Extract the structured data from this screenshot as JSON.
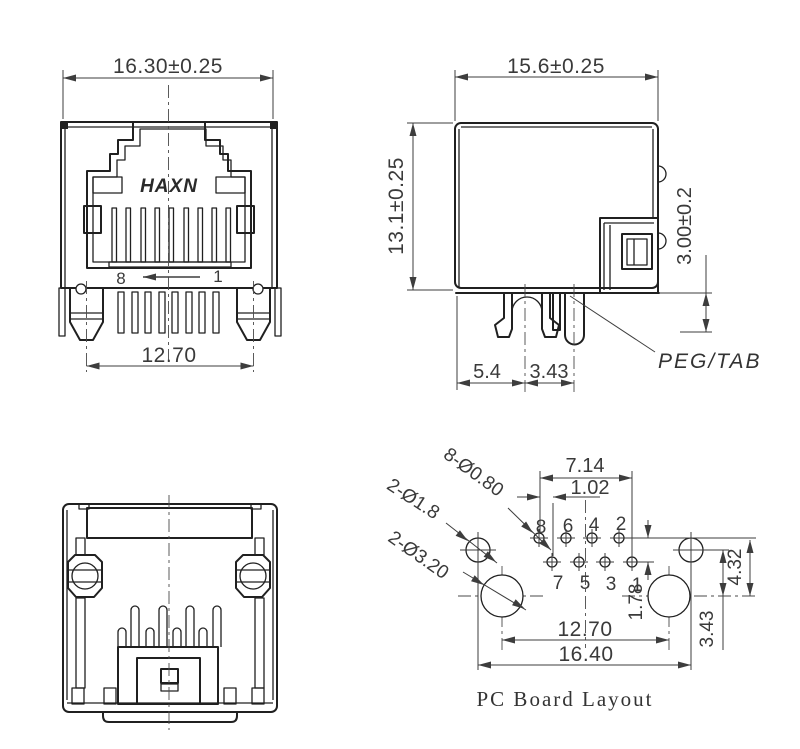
{
  "front_view": {
    "width_dim": "16.30±0.25",
    "peg_spacing_dim": "12.70",
    "brand": "HAXN",
    "pin_left": "8",
    "pin_right": "1"
  },
  "side_view": {
    "depth_dim": "15.6±0.25",
    "height_dim": "13.1±0.25",
    "peg_length_dim": "3.00±0.2",
    "peg_offset_dim": "5.4",
    "peg_pitch_dim": "3.43",
    "peg_label": "PEG/TAB"
  },
  "pcb_layout": {
    "title": "PC Board Layout",
    "pin_span_dim": "7.14",
    "pin_offset_dim": "1.02",
    "row_pitch_dim": "1.78",
    "shield_drop_dim": "4.32",
    "shield_peg_dim": "3.43",
    "peg_spacing_dim": "12.70",
    "shield_spacing_dim": "16.40",
    "callout_pin_holes": "8-Ø0.80",
    "callout_shield_holes": "2-Ø1.8",
    "callout_peg_holes": "2-Ø3.20",
    "pin_labels_top": [
      "8",
      "6",
      "4",
      "2"
    ],
    "pin_labels_bottom": [
      "7",
      "5",
      "3",
      "1"
    ]
  }
}
